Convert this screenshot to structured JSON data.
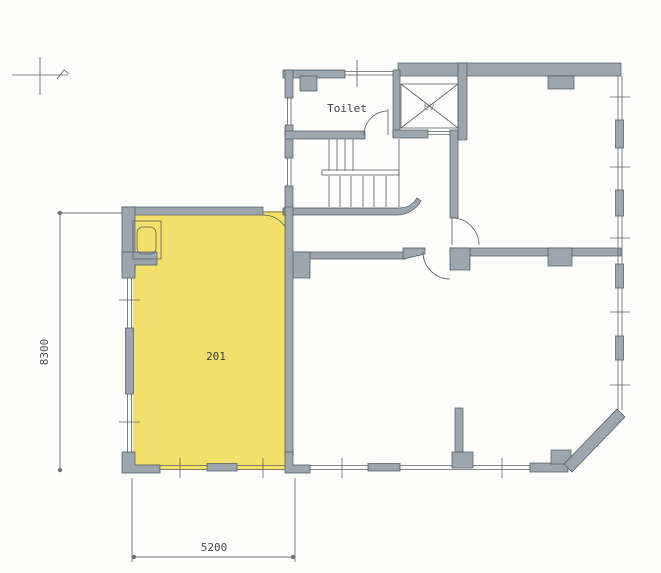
{
  "plan": {
    "room_label": "201",
    "toilet_label": "Toilet",
    "elevator_label": "EV"
  },
  "dimensions": {
    "left_vertical": "8300",
    "bottom_horizontal": "5200"
  },
  "colors": {
    "wall": "#9ca6ae",
    "wall_stroke": "#4d565e",
    "highlight": "#f3e06a",
    "line": "#5a6066",
    "text": "#3c4146",
    "background": "#fdfdfb"
  }
}
